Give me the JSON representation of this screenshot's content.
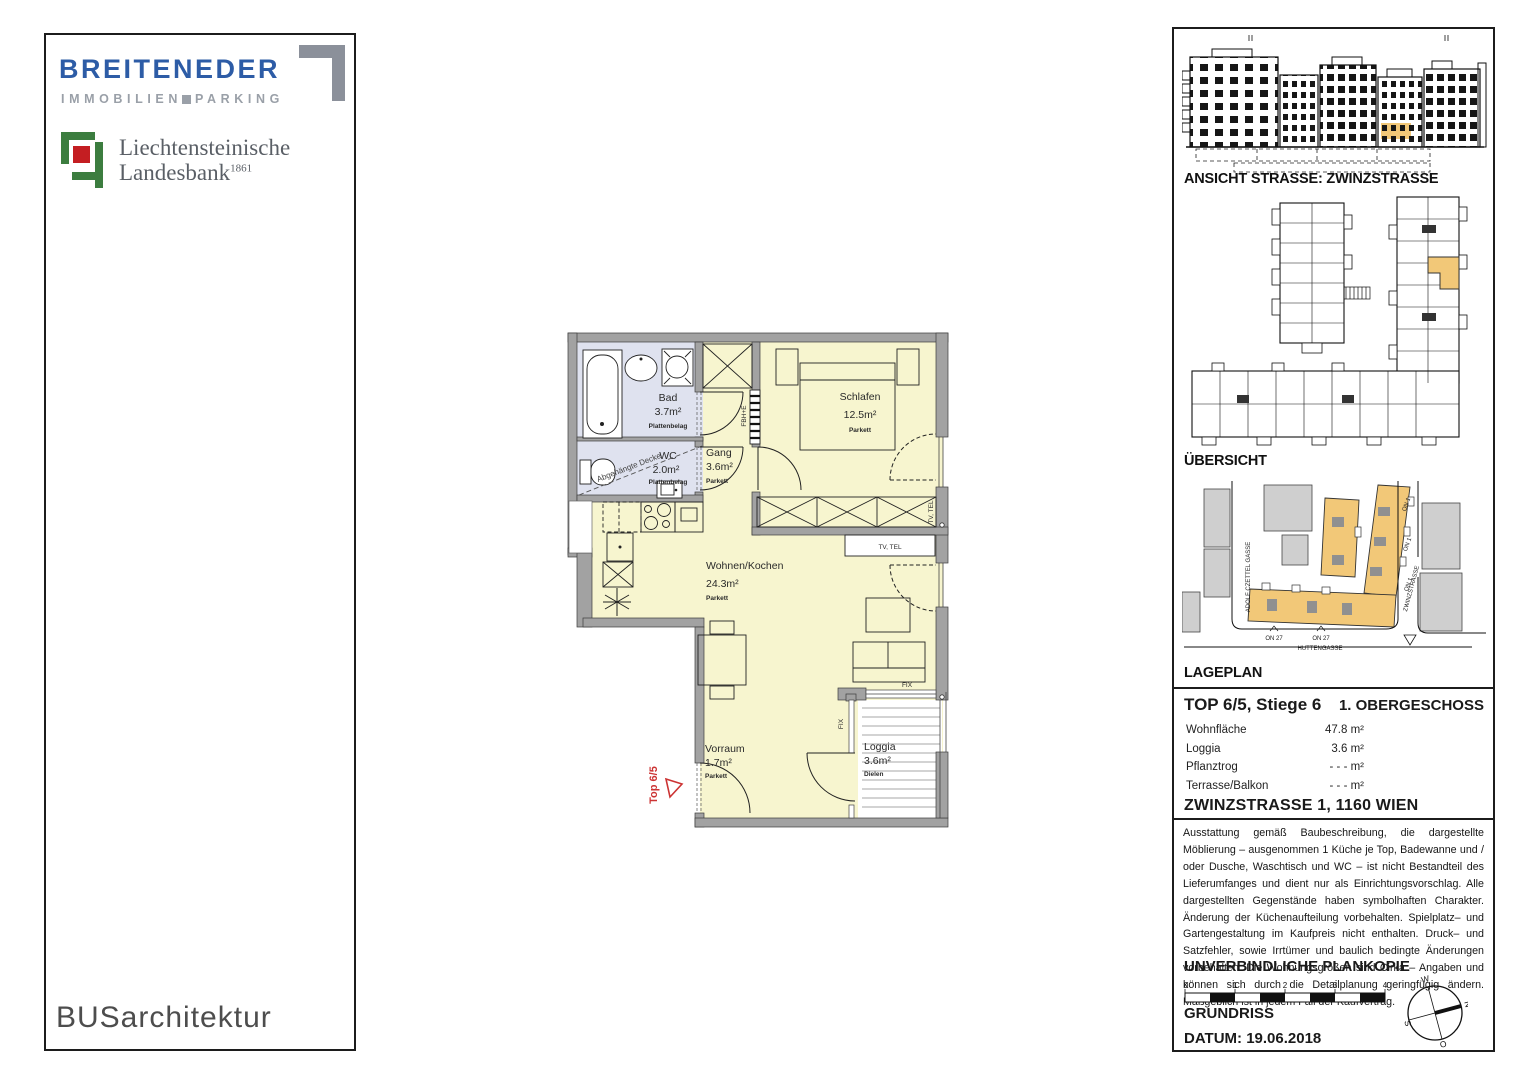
{
  "left_panel": {
    "brand": "BREITENEDER",
    "brand_sub_left": "IMMOBILIEN",
    "brand_sub_right": "PARKING",
    "bank_name_line1": "Liechtensteinische",
    "bank_name_line2": "Landesbank",
    "bank_year": "1861",
    "architect_logo": "BUSarchitektur"
  },
  "floorplan": {
    "unit_marker": "Top 6/5",
    "rooms": {
      "bad": {
        "name": "Bad",
        "area": "3.7m²",
        "floor": "Plattenbelag"
      },
      "wc": {
        "name": "WC",
        "area": "2.0m²",
        "floor": "Plattenbelag"
      },
      "gang": {
        "name": "Gang",
        "area": "3.6m²",
        "floor": "Parkett"
      },
      "schlafen": {
        "name": "Schlafen",
        "area": "12.5m²",
        "floor": "Parkett"
      },
      "wohnen": {
        "name": "Wohnen/Kochen",
        "area": "24.3m²",
        "floor": "Parkett"
      },
      "vorraum": {
        "name": "Vorraum",
        "area": "1.7m²",
        "floor": "Parkett"
      },
      "loggia": {
        "name": "Loggia",
        "area": "3.6m²",
        "floor": "Dielen"
      }
    },
    "labels": {
      "ceiling_note": "Abgehängte Decke",
      "tv_tel_box": "TV, TEL",
      "tv_tel_wall": "TV, TEL",
      "heating": "FBH+E",
      "fix_vertical": "FIX",
      "fix_horizontal": "FIX"
    }
  },
  "right_panel": {
    "ansicht_label": "ANSICHT STRASSE: ZWINZSTRASSE",
    "uebersicht_label": "ÜBERSICHT",
    "lageplan_label": "LAGEPLAN",
    "site": {
      "street_left": "ADOLF CZETTEL GASSE",
      "street_right": "ZWINZSTRASSE",
      "street_bottom": "HUTTENGASSE",
      "on1_a": "ON 1",
      "on1_b": "ON 1",
      "on1_c": "ON 1",
      "on27_a": "ON 27",
      "on27_b": "ON 27"
    },
    "unit_title": "TOP 6/5, Stiege 6",
    "floor_label": "1. OBERGESCHOSS",
    "details": [
      {
        "label": "Wohnfläche",
        "value": "47.8 m²"
      },
      {
        "label": "Loggia",
        "value": "3.6 m²"
      },
      {
        "label": "Pflanztrog",
        "value": "- - -  m²"
      },
      {
        "label": "Terrasse/Balkon",
        "value": "- - -  m²"
      }
    ],
    "address": "ZWINZSTRASSE 1, 1160 WIEN",
    "disclaimer": "Ausstattung gemäß Baubeschreibung, die dargestellte Möblierung – ausgenommen 1 Küche je Top, Badewanne und / oder Dusche, Waschtisch und WC – ist nicht Bestandteil des Lieferumfanges und dient nur als Einrichtungsvorschlag. Alle dargestellten Gegenstände haben symbolhaften Charakter. Änderung der Küchenaufteilung vorbehalten. Spielplatz– und Gartengestaltung im Kaufpreis nicht enthalten. Druck– und Satzfehler, sowie Irrtümer und baulich bedingte Änderungen vorbehalten. Die Wohnungsgrößen sind Cirka – Angaben und können sich durch die Detailplanung geringfügig ändern. Maßgeblich ist in jedem Fall der Kaufvertrag.",
    "plan_copy_label": "UNVERBINDLICHE PLANKOPIE",
    "scale": {
      "t0": "0",
      "t1": "1",
      "t2": "2",
      "t3": "3",
      "t4": "4"
    },
    "drawing_type": "GRUNDRISS",
    "date_label": "DATUM: 19.06.2018",
    "compass": {
      "n": "N",
      "o": "O",
      "s": "S",
      "w": "W"
    }
  },
  "colors": {
    "brand_blue": "#2d5ca6",
    "brand_gray": "#9aa0a8",
    "bank_green": "#3c7d3f",
    "bank_red": "#c41e22",
    "wall_gray": "#a2a2a2",
    "room_yellow": "#f7f5cf",
    "wet_room_blue": "#dfe2ef",
    "highlight_orange": "#f2c878",
    "marker_red": "#cc3333"
  }
}
